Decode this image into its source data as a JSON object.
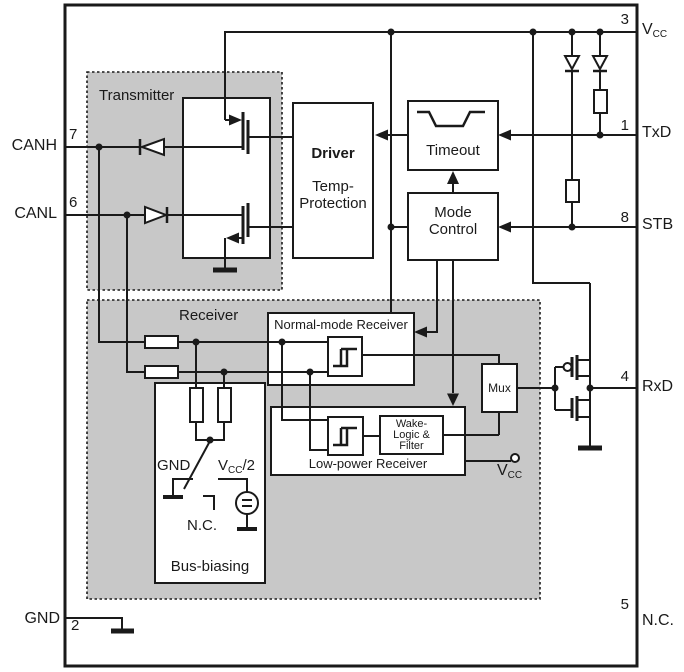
{
  "title": "CAN transceiver block diagram",
  "colors": {
    "line": "#1a1a1a",
    "shade_gray": "#c8c8c8",
    "box_white": "#ffffff"
  },
  "blocks": {
    "transmitter": "Transmitter",
    "receiver": "Receiver",
    "driver": {
      "title": "Driver",
      "sub1": "Temp-",
      "sub2": "Protection"
    },
    "timeout": "Timeout",
    "mode_control": {
      "line1": "Mode",
      "line2": "Control"
    },
    "normal_mode_receiver": "Normal-mode Receiver",
    "low_power_receiver": "Low-power Receiver",
    "wake": {
      "line1": "Wake-",
      "line2": "Logic &",
      "line3": "Filter"
    },
    "mux": "Mux",
    "bus_biasing": "Bus-biasing"
  },
  "bias": {
    "gnd": "GND",
    "nc": "N.C.",
    "vcc_v": "V",
    "vcc_sub": "CC",
    "vcc_half": "/2"
  },
  "vcc_terminal": {
    "v": "V",
    "sub": "CC"
  },
  "pins": {
    "left": [
      {
        "num": "7",
        "label": "CANH"
      },
      {
        "num": "6",
        "label": "CANL"
      },
      {
        "num": "2",
        "label": "GND"
      }
    ],
    "right": [
      {
        "num": "3",
        "label_v": "V",
        "label_sub": "CC"
      },
      {
        "num": "1",
        "label": "TxD"
      },
      {
        "num": "8",
        "label": "STB"
      },
      {
        "num": "4",
        "label": "RxD"
      },
      {
        "num": "5",
        "label": "N.C."
      }
    ]
  },
  "icons": {
    "diode": "triangle-with-bar",
    "resistor": "open-rect",
    "ground": "thick-bar",
    "hysteresis": "schmitt-step-glyph",
    "voltage_source": "circled-equals",
    "timeout_pulse": "notch-waveform",
    "mosfet": "mos-transistor-symbol",
    "junction": "filled-dot",
    "open_terminal": "open-circle",
    "switch": "diagonal-blade"
  }
}
